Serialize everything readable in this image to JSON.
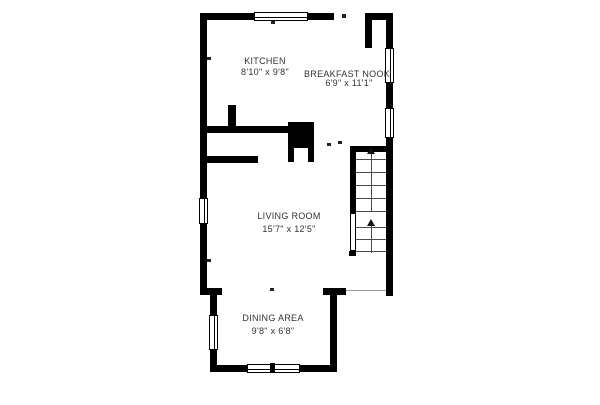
{
  "plan": {
    "title": "first-floor-plan",
    "rooms": [
      {
        "id": "kitchen",
        "name": "KITCHEN",
        "dims": "8'10\" x 9'8\""
      },
      {
        "id": "breakfast-nook",
        "name": "BREAKFAST NOOK",
        "dims": "6'9\" x 11'1\""
      },
      {
        "id": "living-room",
        "name": "LIVING ROOM",
        "dims": "15'7\" x 12'5\""
      },
      {
        "id": "dining-area",
        "name": "DINING AREA",
        "dims": "9'8\" x 6'8\""
      }
    ],
    "features": {
      "stairs": "staircase-up",
      "fireplace": "fireplace",
      "windows": 6,
      "door_openings": 3
    },
    "colors": {
      "wall": "#000000",
      "background": "#ffffff",
      "tread_line": "#4a4a4a",
      "text": "#333333"
    }
  }
}
